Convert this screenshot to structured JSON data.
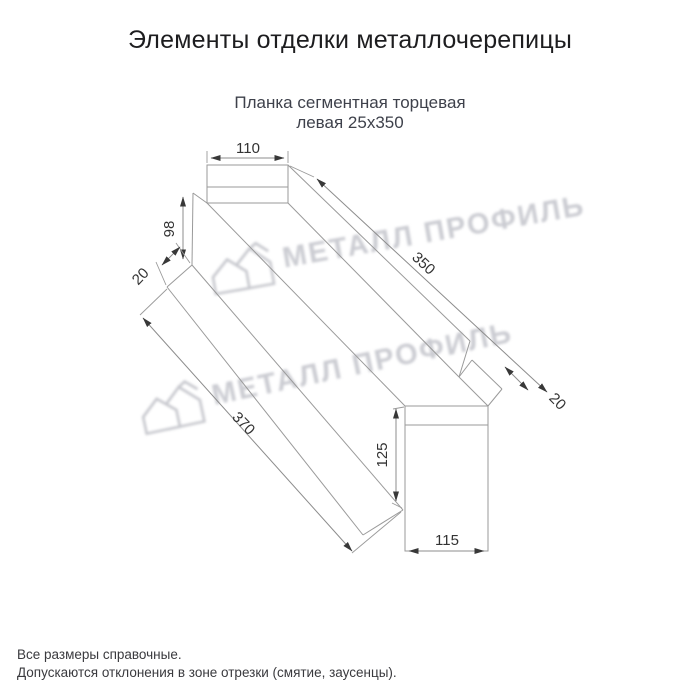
{
  "header": {
    "title": "Элементы отделки металлочерепицы"
  },
  "subtitle": {
    "line1": "Планка сегментная торцевая",
    "line2": "левая 25х350"
  },
  "drawing": {
    "product": "Планка сегментная торцевая левая 25х350",
    "dims": {
      "top_flange_width": "110",
      "left_end_height": "98",
      "left_hem": "20",
      "length_top": "350",
      "length_bottom": "370",
      "right_hem": "20",
      "right_end_height": "125",
      "right_end_width": "115"
    }
  },
  "watermark": {
    "text": "МЕТАЛЛ ПРОФИЛЬ",
    "color": "#cbccd2"
  },
  "footer": {
    "note1": "Все размеры справочные.",
    "note2": "Допускаются отклонения в зоне отрезки (смятие, заусенцы)."
  },
  "colors": {
    "background": "#ffffff",
    "title_text": "#1d1d1f",
    "subtitle_text": "#3e414b",
    "drawing_lines": "#9a9a9a",
    "dimension_text": "#333333"
  }
}
